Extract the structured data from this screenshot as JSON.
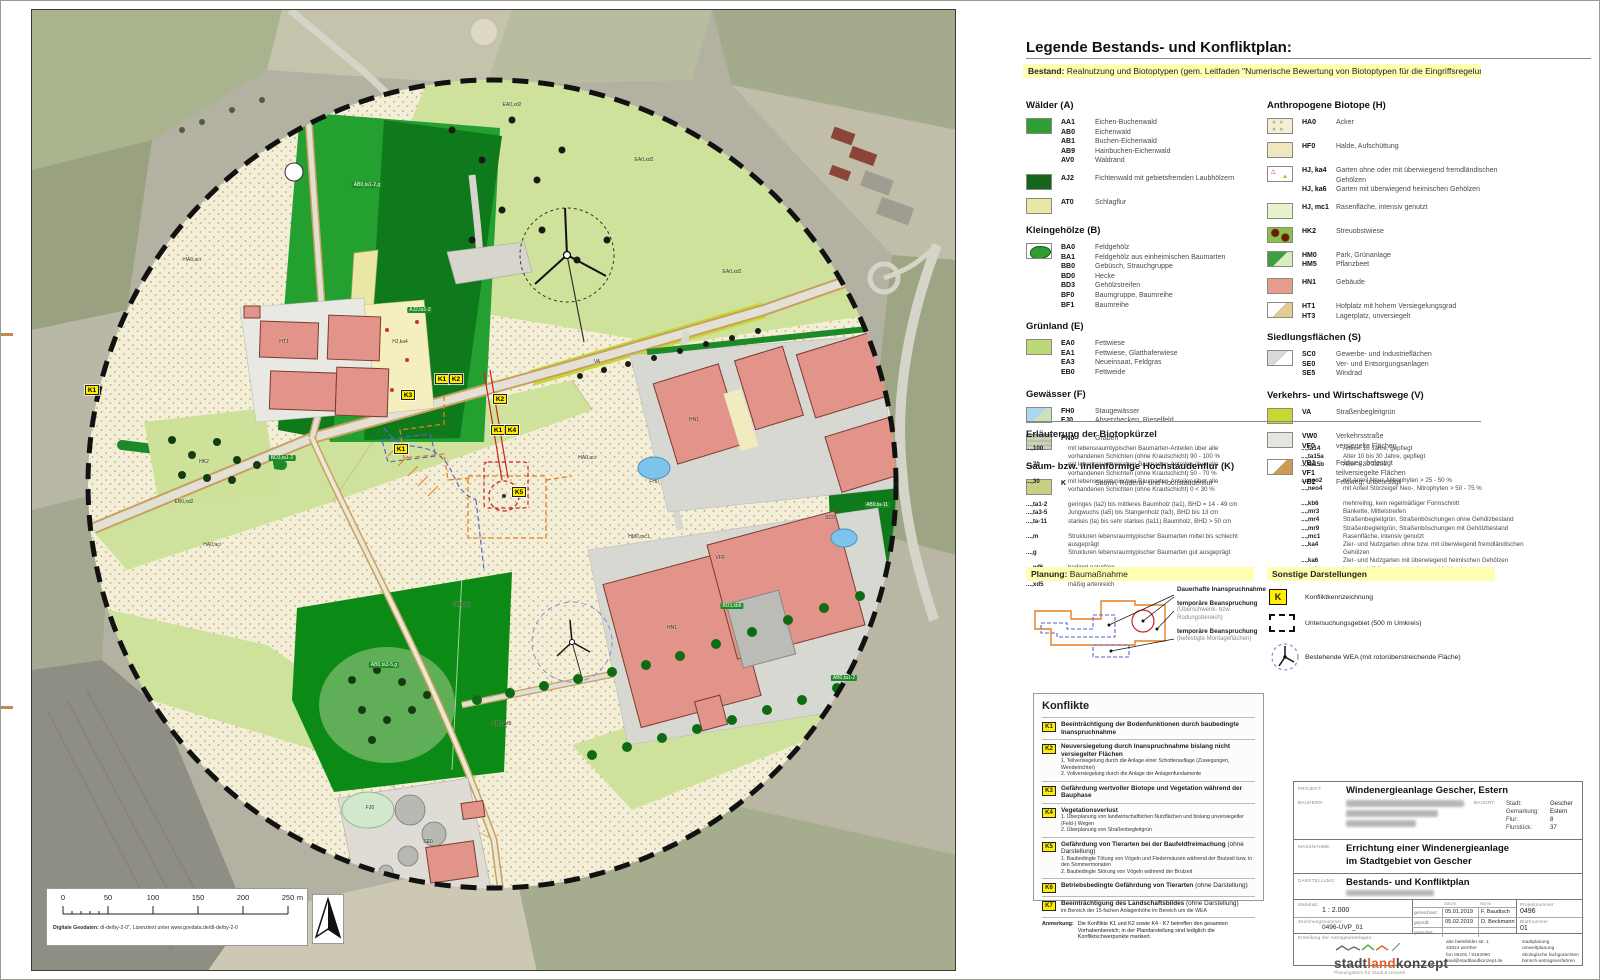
{
  "colors": {
    "legend_bar": "#ffffb3",
    "conflict_yellow": "#ffee00",
    "building_fill": "#e2938a",
    "forest_green": "#23a02f",
    "dark_forest": "#0e7a1c",
    "meadow": "#cfe29b",
    "acker": "#f3eed6",
    "logo_accent": "#e0632a"
  },
  "legend": {
    "title": "Legende Bestands- und Konfliktplan:",
    "bestand_prefix": "Bestand:",
    "bestand_text": " Realnutzung und Biotoptypen (gem. Leitfaden \"Numerische Bewertung von Biotoptypen für die Eingriffsregelung\")",
    "left_groups": [
      {
        "title": "Wälder (A)",
        "entries": [
          {
            "swatch": "aa",
            "rows": [
              [
                "AA1",
                "Eichen-Buchenwald"
              ],
              [
                "AB0",
                "Eichenwald"
              ],
              [
                "AB1",
                "Buchen-Eichenwald"
              ],
              [
                "AB9",
                "Hainbuchen-Eichenwald"
              ],
              [
                "AV0",
                "Waldrand"
              ]
            ]
          },
          {
            "swatch": "aj",
            "rows": [
              [
                "AJ2",
                "Fichtenwald mit gebietsfremden Laubhölzern"
              ]
            ]
          },
          {
            "swatch": "at",
            "rows": [
              [
                "AT0",
                "Schlagflur"
              ]
            ]
          }
        ]
      },
      {
        "title": "Kleingehölze (B)",
        "entries": [
          {
            "swatch": "ba",
            "rows": [
              [
                "BA0",
                "Feldgehölz"
              ],
              [
                "BA1",
                "Feldgehölz aus einheimischen Baumarten"
              ],
              [
                "BB0",
                "Gebüsch, Strauchgruppe"
              ],
              [
                "BD0",
                "Hecke"
              ],
              [
                "BD3",
                "Gehölzstreifen"
              ],
              [
                "BF0",
                "Baumgruppe, Baumreihe"
              ],
              [
                "BF1",
                "Baumreihe"
              ]
            ]
          }
        ]
      },
      {
        "title": "Grünland (E)",
        "entries": [
          {
            "swatch": "ea",
            "rows": [
              [
                "EA0",
                "Fettwiese"
              ],
              [
                "EA1",
                "Fettwiese, Glatthaferwiese"
              ],
              [
                "EA3",
                "Neueinsaat, Feldgras"
              ],
              [
                "EB0",
                "Fettweide"
              ]
            ]
          }
        ]
      },
      {
        "title": "Gewässer (F)",
        "entries": [
          {
            "swatch": "fh",
            "rows": [
              [
                "FH0",
                "Staugewässer"
              ],
              [
                "FJ0",
                "Absetzbecken, Rieselfeld"
              ]
            ]
          },
          {
            "swatch": "fn",
            "rows": [
              [
                "FN0",
                "Graben"
              ]
            ]
          }
        ]
      },
      {
        "title": "Saum- bzw. linienförmige Hochstaudenflur (K)",
        "entries": [
          {
            "swatch": "k",
            "rows": [
              [
                "K",
                "Saum-, Ruderal- und Hochstaudenflur"
              ]
            ]
          }
        ]
      }
    ],
    "right_groups": [
      {
        "title": "Anthropogene Biotope (H)",
        "entries": [
          {
            "swatch": "ha",
            "rows": [
              [
                "HA0",
                "Acker"
              ]
            ]
          },
          {
            "swatch": "hf",
            "rows": [
              [
                "HF0",
                "Halde, Aufschüttung"
              ]
            ]
          },
          {
            "swatch": "hj",
            "rows": [
              [
                "HJ, ka4",
                "Garten ohne oder mit überwiegend fremdländischen Gehölzen"
              ],
              [
                "HJ, ka6",
                "Garten mit überwiegend heimischen Gehölzen"
              ]
            ]
          },
          {
            "swatch": "hjmc",
            "rows": [
              [
                "HJ, mc1",
                "Rasenfläche, intensiv genutzt"
              ]
            ]
          },
          {
            "swatch": "hk",
            "rows": [
              [
                "HK2",
                "Streuobstwiese"
              ]
            ]
          },
          {
            "swatch": "hm",
            "rows": [
              [
                "HM0",
                "Park, Grünanlage"
              ],
              [
                "HM5",
                "Pflanzbeet"
              ]
            ]
          },
          {
            "swatch": "hn",
            "rows": [
              [
                "HN1",
                "Gebäude"
              ]
            ]
          },
          {
            "swatch": "ht",
            "rows": [
              [
                "HT1",
                "Hofplatz mit hohem Versiegelungsgrad"
              ],
              [
                "HT3",
                "Lagerplatz, unversiegelt"
              ]
            ]
          }
        ]
      },
      {
        "title": "Siedlungsflächen (S)",
        "entries": [
          {
            "swatch": "sc",
            "rows": [
              [
                "SC0",
                "Gewerbe- und Industrieflächen"
              ],
              [
                "SE0",
                "Ver- und Entsorgungsanlagen"
              ],
              [
                "SE5",
                "Windrad"
              ]
            ]
          }
        ]
      },
      {
        "title": "Verkehrs- und Wirtschaftswege (V)",
        "entries": [
          {
            "swatch": "va",
            "rows": [
              [
                "VA",
                "Straßenbegleitgrün"
              ]
            ]
          },
          {
            "swatch": "vw",
            "rows": [
              [
                "VW0",
                "Verkehrsstraße"
              ],
              [
                "VF0",
                "versiegelte Flächen"
              ]
            ]
          },
          {
            "swatch": "vb",
            "rows": [
              [
                "VB1",
                "Feldweg, befestigt"
              ],
              [
                "VF1",
                "teilversiegelte Flächen"
              ],
              [
                "VB2",
                "Feldweg, unbefestigt"
              ]
            ]
          }
        ]
      }
    ],
    "erlaeuterung_title": "Erläuterung der Biotopkürzel",
    "erl_left": [
      [
        {
          "c": "...,100",
          "d": "mit lebensraumtypischen Baumarten-Anteilen über alle vorhandenen Schichten (ohne Krautschicht) 90 - 100 %"
        },
        {
          "c": "...,70",
          "d": "mit lebensraumtypischen Baumarten-Anteilen über alle vorhandenen Schichten (ohne Krautschicht) 50 - 70 %"
        },
        {
          "c": "...,30",
          "d": "mit lebensraumtypischen Baumarten-Anteilen über alle vorhandenen Schichten (ohne Krautschicht) 0 < 30 %"
        }
      ],
      [
        {
          "c": "...,ta1-2",
          "d": "geringes (ta2) bis mittleres Baumholz (ta1), BHD = 14 - 49 cm"
        },
        {
          "c": "...,ta3-5",
          "d": "Jungwuchs (ta5) bis Stangenholz (ta3), BHD bis 13 cm"
        },
        {
          "c": "...,ta-11",
          "d": "starkes (ta) bis sehr starkes (ta11) Baumholz, BHD > 50 cm"
        }
      ],
      [
        {
          "c": "...,m",
          "d": "Strukturen lebensraumtypischer Baumarten mittel bis schlecht ausgeprägt"
        },
        {
          "c": "...,g",
          "d": "Strukturen lebensraumtypischer Baumarten gut ausgeprägt"
        }
      ],
      [
        {
          "c": "...,wf6",
          "d": "bedingt naturfern"
        },
        {
          "c": "...,xd2",
          "d": "artenarm"
        },
        {
          "c": "...,xd5",
          "d": "mäßig artenreich"
        }
      ]
    ],
    "erl_right": [
      [
        {
          "c": "...,ta14",
          "d": "Alter < 10 Jahre, gepflegt"
        },
        {
          "c": "...,ta15a",
          "d": "Alter 10 bis 30 Jahre, gepflegt"
        },
        {
          "c": "...,ta15b",
          "d": "Alter > 30 Jahre"
        }
      ],
      [
        {
          "c": "...,neo2",
          "d": "mit Anteil Neo-, Nitrophyten > 25 - 50 %"
        },
        {
          "c": "...,neo4",
          "d": "mit Anteil Störzeiger Neo-, Nitrophyten > 50 - 75 %"
        }
      ],
      [
        {
          "c": "...,kb6",
          "d": "mehrreihig, kein regelmäßiger Formschnitt"
        },
        {
          "c": "...,mr3",
          "d": "Bankette, Mittelstreifen"
        },
        {
          "c": "...,mr4",
          "d": "Straßenbegleitgrün, Straßenböschungen ohne Gehölzbestand"
        },
        {
          "c": "...,mr9",
          "d": "Straßenbegleitgrün, Straßenböschungen mit Gehölzbestand"
        },
        {
          "c": "...,mc1",
          "d": "Rasenfläche, intensiv genutzt"
        },
        {
          "c": "...,ka4",
          "d": "Zier- und Nutzgarten ohne bzw. mit überwiegend fremdländischen Gehölzen"
        },
        {
          "c": "...,ka6",
          "d": "Zier- und Nutzgarten mit überwiegend heimischen Gehölzen"
        },
        {
          "c": "...,aci",
          "d": "intensiv, Wildkrautarten weitgehend fehlend"
        }
      ]
    ],
    "planung_prefix": "Planung:",
    "planung_title": " Baumaßnahme",
    "planung_items": [
      {
        "main": "Dauerhafte Inanspruchnahme",
        "sub": ""
      },
      {
        "main": "temporäre Beanspruchung",
        "sub": "(Überschwenk- bzw. Rodungsbereich)"
      },
      {
        "main": "temporäre Beanspruchung",
        "sub": "(befestigte Montageflächen)"
      }
    ],
    "sonstige_title": "Sonstige Darstellungen",
    "sonstige_items": [
      {
        "icon": "k",
        "symbol": "K",
        "label": "Konfliktkennzeichnung"
      },
      {
        "icon": "rect",
        "label": "Untersuchungsgebiet (500 m Umkreis)"
      },
      {
        "icon": "wea",
        "label": "Bestehende WEA (mit rotorüberstreichende Fläche)"
      }
    ]
  },
  "konflikte": {
    "title": "Konflikte",
    "rows": [
      {
        "badge": "K1",
        "main": "Beeinträchtigung der Bodenfunktionen durch baubedingte Inanspruchnahme",
        "note": "",
        "subs": []
      },
      {
        "badge": "K2",
        "main": "Neuversiegelung durch Inanspruchnahme bislang nicht versiegelter Flächen",
        "note": "",
        "subs": [
          "1. Teilversiegelung durch die Anlage einer Schotterauflage (Zuwegungen, Wendetrichter)",
          "2. Vollversiegelung durch die Anlage der Anlagenfundamente"
        ]
      },
      {
        "badge": "K3",
        "main": "Gefährdung wertvoller Biotope und Vegetation während der Bauphase",
        "note": "",
        "subs": []
      },
      {
        "badge": "K4",
        "main": "Vegetationsverlust",
        "note": "",
        "subs": [
          "1. Überplanung von landwirtschaftlichen Nutzflächen und bislang unversiegelter (Feld-) Wegen",
          "2. Überplanung von Straßenbegleitgrün"
        ]
      },
      {
        "badge": "K5",
        "main": "Gefährdung von Tierarten bei der Baufeldfreimachung",
        "note": " (ohne Darstellung)",
        "subs": [
          "1. Baubedingte Tötung von Vögeln und Fledermäusen während der Brutzeit bzw. in den Sommermonaten",
          "2. Baubedingte Störung von Vögeln während der Brutzeit"
        ]
      },
      {
        "badge": "K6",
        "main": "Betriebsbedingte Gefährdung von Tierarten",
        "note": " (ohne Darstellung)",
        "subs": []
      },
      {
        "badge": "K7",
        "main": "Beeinträchtigung des Landschaftsbildes",
        "note": " (ohne Darstellung)",
        "subs": [
          "im Bereich der 15-fachen Anlagenhöhe im Bereich um die WEA"
        ]
      }
    ],
    "anmerkung_label": "Anmerkung:",
    "anmerkung": "Die Konflikte K1 und K2 sowie K4 - K7 betreffen den gesamten Vorhabenbereich; in der Plandarstellung sind lediglich die Konfliktschwerpunkte markiert."
  },
  "titleblock": {
    "projekt_label": "PROJEKT:",
    "projekt": "Windenergieanlage Gescher, Estern",
    "bauherr_label": "BAUHERR:",
    "bauort_label": "BAUORT:",
    "bauort": [
      [
        "Stadt:",
        "Gescher"
      ],
      [
        "Gemarkung:",
        "Estern"
      ],
      [
        "Flur:",
        "8"
      ],
      [
        "Flurstück:",
        "37"
      ]
    ],
    "massnahme_label": "MASSNAHME:",
    "massnahme_line1": "Errichtung einer Windenergieanlage",
    "massnahme_line2": "im Stadtgebiet von Gescher",
    "darstellung_label": "DARSTELLUNG:",
    "darstellung": "Bestands- und Konfliktplan",
    "massstab_label": "Maßstab:",
    "massstab": "1 : 2.000",
    "zeichnung_label": "Zeichnungsnummer:",
    "zeichnung": "0496-UVP_01",
    "sign_header": [
      "",
      "Datum",
      "Name"
    ],
    "sign_rows": [
      [
        "gezeichnet:",
        "05.01.2019",
        "F. Baudisch"
      ],
      [
        "geprüft:",
        "05.02.2019",
        "D. Beckmann"
      ],
      [
        "geändert:",
        "",
        ""
      ]
    ],
    "projektnr_label": "Projektnummer",
    "projektnr": "0496",
    "blatt_label": "Blattnummer",
    "blatt": "01",
    "antrag_label": "Erstellung der Antragsunterlagen:",
    "logo": {
      "part1": "stadt",
      "part2": "land",
      "part3": "konzept",
      "tagline": "Planungsbüro für Stadt & Umwelt"
    },
    "address": [
      "alte bielefelder str. 1",
      "33824 werther",
      "fon 05201 / 9182090",
      "mail@stadtlandkonzept.de"
    ],
    "services": [
      "stadtplanung",
      "umweltplanung",
      "ökologische fachgutachten",
      "bimsch-antragsverfahren"
    ]
  },
  "map": {
    "scalebar_numbers": [
      "0",
      "50",
      "100",
      "150",
      "200",
      "250"
    ],
    "scalebar_unit": "m",
    "note_label": "Digitale Geodaten:",
    "note": " dl-de/by-2-0\", Lizenztext unter www.govdata.de/dl-de/by-2-0",
    "k_badges": [
      [
        "K1",
        60,
        380
      ],
      [
        "K3",
        376,
        385
      ],
      [
        "K1",
        410,
        369
      ],
      [
        "K2",
        424,
        369
      ],
      [
        "K2",
        468,
        389
      ],
      [
        "K1",
        466,
        420
      ],
      [
        "K4",
        480,
        420
      ],
      [
        "K1",
        369,
        439
      ],
      [
        "K5",
        487,
        482
      ]
    ],
    "labels": [
      {
        "t": "AB0,ta1-2,g",
        "x": 335,
        "y": 175,
        "f": 1
      },
      {
        "t": "AJ2,ta1-2",
        "x": 388,
        "y": 300,
        "f": 1
      },
      {
        "t": "AB0,ta3-5,g",
        "x": 352,
        "y": 655,
        "f": 1
      },
      {
        "t": "AB9,ta-11",
        "x": 845,
        "y": 495,
        "f": 1
      },
      {
        "t": "BD3,kb6",
        "x": 700,
        "y": 596,
        "f": 1
      },
      {
        "t": "AB0,ta1-2",
        "x": 812,
        "y": 668,
        "f": 1
      },
      {
        "t": "BD3,ta1-2",
        "x": 250,
        "y": 448,
        "f": 1
      },
      {
        "t": "HA0,aci",
        "x": 180,
        "y": 535,
        "f": 0
      },
      {
        "t": "HA0,aci",
        "x": 555,
        "y": 448,
        "f": 0
      },
      {
        "t": "HA0,aci",
        "x": 160,
        "y": 250,
        "f": 0
      },
      {
        "t": "HA0,aci",
        "x": 430,
        "y": 595,
        "f": 0
      },
      {
        "t": "EA0,xd2",
        "x": 612,
        "y": 150,
        "f": 0
      },
      {
        "t": "EA0,xd2",
        "x": 700,
        "y": 262,
        "f": 0
      },
      {
        "t": "EA0,xd2",
        "x": 480,
        "y": 95,
        "f": 0
      },
      {
        "t": "EB0,xd2",
        "x": 152,
        "y": 492,
        "f": 0
      },
      {
        "t": "HN1",
        "x": 662,
        "y": 410,
        "f": 0
      },
      {
        "t": "HN1",
        "x": 640,
        "y": 618,
        "f": 0
      },
      {
        "t": "VF0",
        "x": 688,
        "y": 548,
        "f": 0
      },
      {
        "t": "SC0",
        "x": 798,
        "y": 508,
        "f": 0
      },
      {
        "t": "FN0,wf6",
        "x": 470,
        "y": 714,
        "f": 0
      },
      {
        "t": "HM0,mc1",
        "x": 607,
        "y": 527,
        "f": 0
      },
      {
        "t": "HK2",
        "x": 172,
        "y": 452,
        "f": 0
      },
      {
        "t": "HJ,ka4",
        "x": 368,
        "y": 332,
        "f": 0
      },
      {
        "t": "HT1",
        "x": 252,
        "y": 332,
        "f": 0
      },
      {
        "t": "FH0",
        "x": 622,
        "y": 472,
        "f": 0
      },
      {
        "t": "FJ0",
        "x": 338,
        "y": 798,
        "f": 0
      },
      {
        "t": "SE0",
        "x": 396,
        "y": 832,
        "f": 0
      },
      {
        "t": "VA",
        "x": 565,
        "y": 352,
        "f": 0
      }
    ]
  }
}
